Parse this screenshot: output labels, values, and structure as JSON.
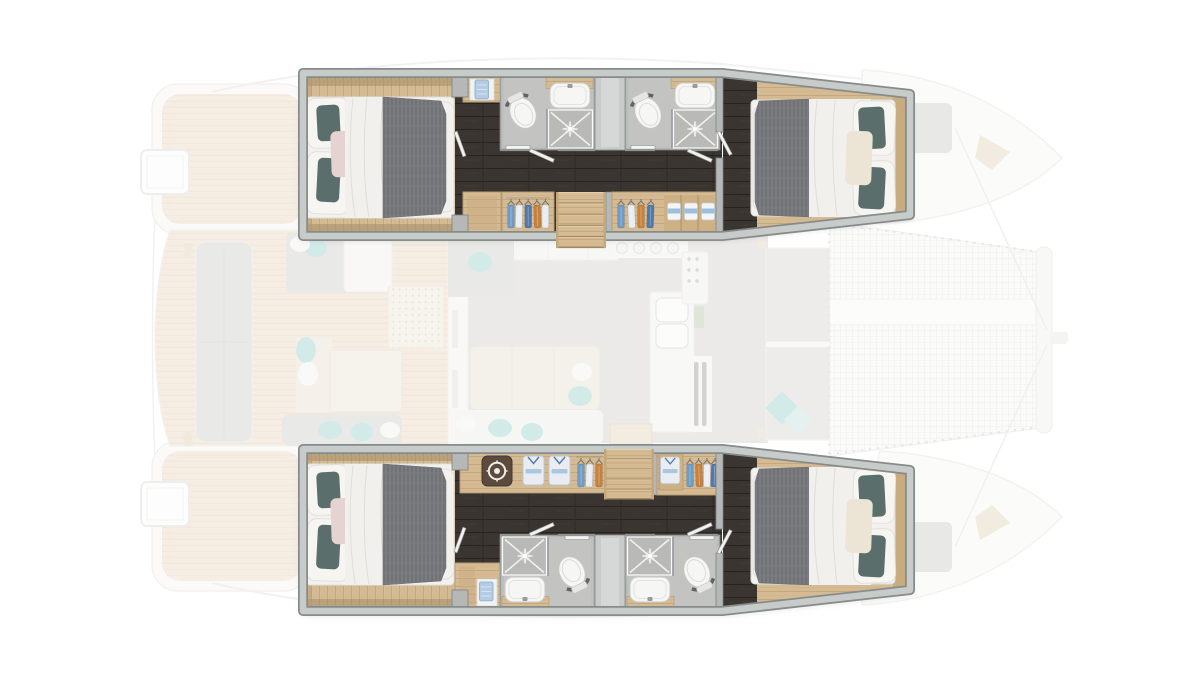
{
  "scene": {
    "type": "yacht-floor-plan",
    "vessel": "catamaran",
    "view": "top-down interior layout",
    "highlighted_areas": [
      "port-hull-interior",
      "starboard-hull-interior"
    ],
    "faded_areas": [
      "stern-platforms",
      "aft-cockpit",
      "salon-galley",
      "foredeck-lounge",
      "trampolines",
      "bow-hulls"
    ]
  },
  "inventory": {
    "cabins": [
      {
        "name": "port-aft-cabin",
        "furniture": [
          "double-bed"
        ],
        "pillows": {
          "white": 2,
          "teal": 2,
          "pink": 1
        }
      },
      {
        "name": "port-forward-cabin",
        "furniture": [
          "double-bed"
        ],
        "pillows": {
          "white": 2,
          "teal": 2,
          "cream": 1
        }
      },
      {
        "name": "starboard-aft-cabin",
        "furniture": [
          "double-bed"
        ],
        "pillows": {
          "white": 2,
          "teal": 2,
          "pink": 1
        }
      },
      {
        "name": "starboard-forward-cabin",
        "furniture": [
          "double-bed"
        ],
        "pillows": {
          "white": 2,
          "teal": 2,
          "cream": 1
        }
      }
    ],
    "bathrooms": [
      {
        "name": "port-aft-bathroom",
        "fixtures": [
          "toilet",
          "washbasin",
          "shower"
        ]
      },
      {
        "name": "port-forward-bathroom",
        "fixtures": [
          "toilet",
          "washbasin",
          "shower"
        ]
      },
      {
        "name": "starboard-aft-bathroom",
        "fixtures": [
          "toilet",
          "washbasin",
          "shower"
        ]
      },
      {
        "name": "starboard-forward-bathroom",
        "fixtures": [
          "toilet",
          "washbasin",
          "shower"
        ]
      }
    ],
    "storage": [
      {
        "name": "port-aft-wardrobe",
        "hangers": 5
      },
      {
        "name": "port-forward-wardrobe",
        "hangers": 4,
        "towel_shelves": 3
      },
      {
        "name": "starboard-safe-wardrobe",
        "safe": 1,
        "folded_shirts": 2,
        "hangers": 3
      },
      {
        "name": "starboard-forward-wardrobe",
        "folded_shirts": 1,
        "hangers": 4
      },
      {
        "name": "towel-niches",
        "count": 2
      }
    ],
    "staircases": [
      {
        "name": "port-staircase",
        "steps": 5
      },
      {
        "name": "starboard-staircase",
        "steps": 5
      }
    ],
    "trampoline_panels": 2
  },
  "colors": {
    "hull-band": "#c7cbca",
    "hull-line": "#868c8b",
    "wood": "#d5bb93",
    "wood-line": "#c2a277",
    "wood-dark": "#b59a74",
    "plank": "#3a3531",
    "duvet": "#76777b",
    "sheet": "#f2f1ed",
    "sheet-line": "#e0dfdb",
    "teal": "#5a6f6b",
    "pink": "#e5d3d2",
    "cream": "#ece4d4",
    "bath-floor": "#c3c4c2",
    "bath-wall": "#9a9d9c",
    "tile": "#b9bab8",
    "fixture": "#f6f6f4",
    "wall": "#b5b8b7",
    "divider": "#c9cbca",
    "safe": "#5b4a3d",
    "cloth-blue": "#6f9cc6",
    "cloth-blue-dark": "#4f79ae",
    "cloth-orange": "#c7813f",
    "cloth-white": "#e9edf1",
    "towel": "#9fc0dc",
    "towel-light": "#b3cce4",
    "deck-bg": "#eedfca",
    "deck-line": "#e2d0b5",
    "faded-gray": "#d8d7d5",
    "faded-bench": "#d5d4d2",
    "faded-cream": "#ece5d7",
    "faded-white": "#f4f3f1",
    "faded-teal": "#a7d8d4",
    "faded-outline": "#e6e5e3",
    "beam": "#f3f2f0"
  }
}
